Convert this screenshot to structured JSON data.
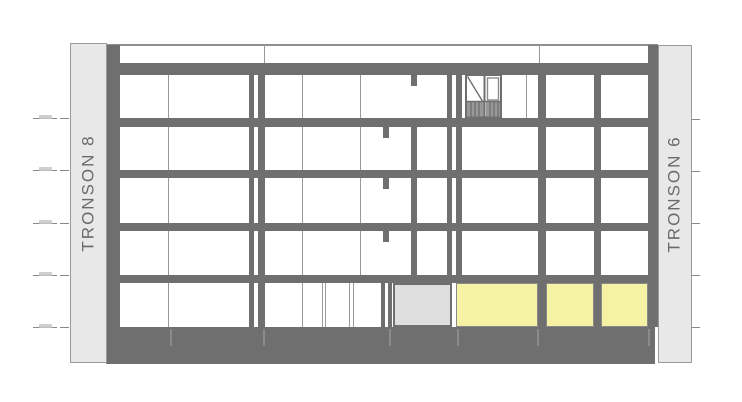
{
  "drawing": {
    "left_band_label": "TRONSON 8",
    "right_band_label": "TRONSON 6",
    "floor_count": 5,
    "level_markers_per_side": 5,
    "highlighted_panel_count": 3
  },
  "colors": {
    "background": "#ffffff",
    "structure_gray": "#6f6f6f",
    "band_fill": "#e8e8e8",
    "band_border": "#9a9a9a",
    "line_gray": "#9a9a9a",
    "light_line": "#8f8f8f",
    "panel_gray": "#dedede",
    "highlight_yellow": "#f5f3a3",
    "label_text": "#6a6a6a",
    "marker_gray": "#8a8a8a"
  }
}
